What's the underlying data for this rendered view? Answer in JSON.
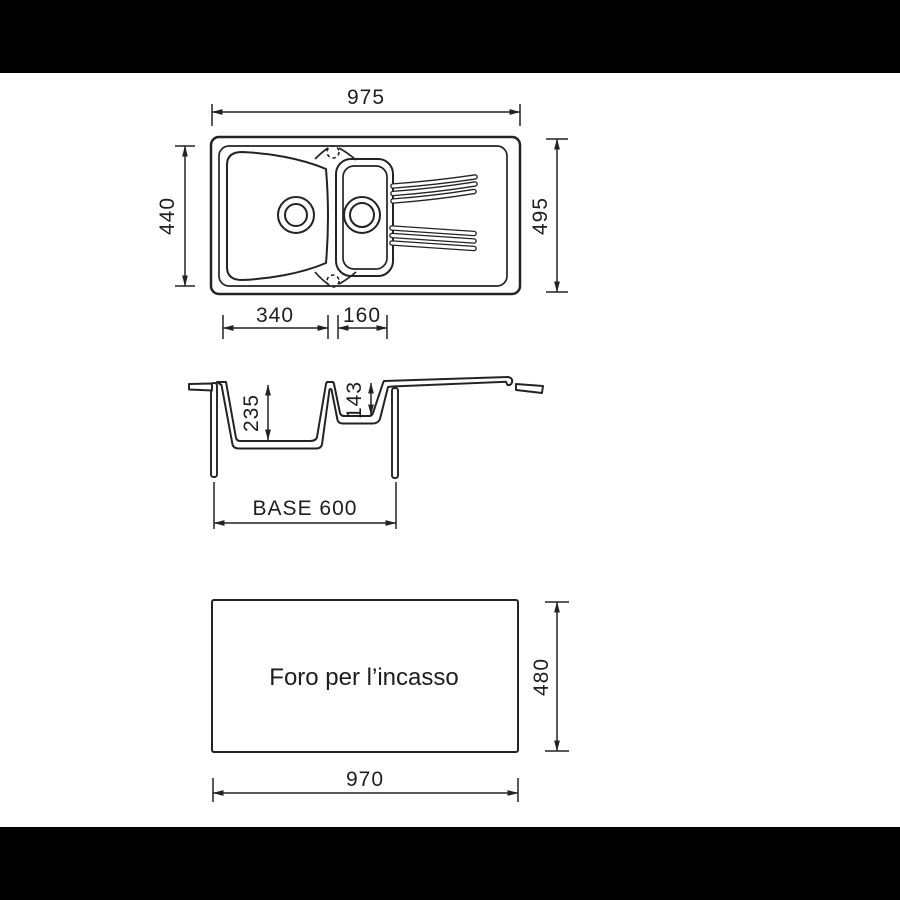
{
  "colors": {
    "background": "#ffffff",
    "letterbox": "#000000",
    "line": "#232323"
  },
  "top_view": {
    "width_label": "975",
    "outer_depth_label": "495",
    "inner_depth_label": "440",
    "main_bowl_width_label": "340",
    "half_bowl_width_label": "160"
  },
  "section_view": {
    "main_bowl_depth_label": "235",
    "half_bowl_depth_label": "143",
    "base_width_label": "BASE 600"
  },
  "cutout_view": {
    "caption": "Foro per l’incasso",
    "width_label": "970",
    "height_label": "480"
  }
}
